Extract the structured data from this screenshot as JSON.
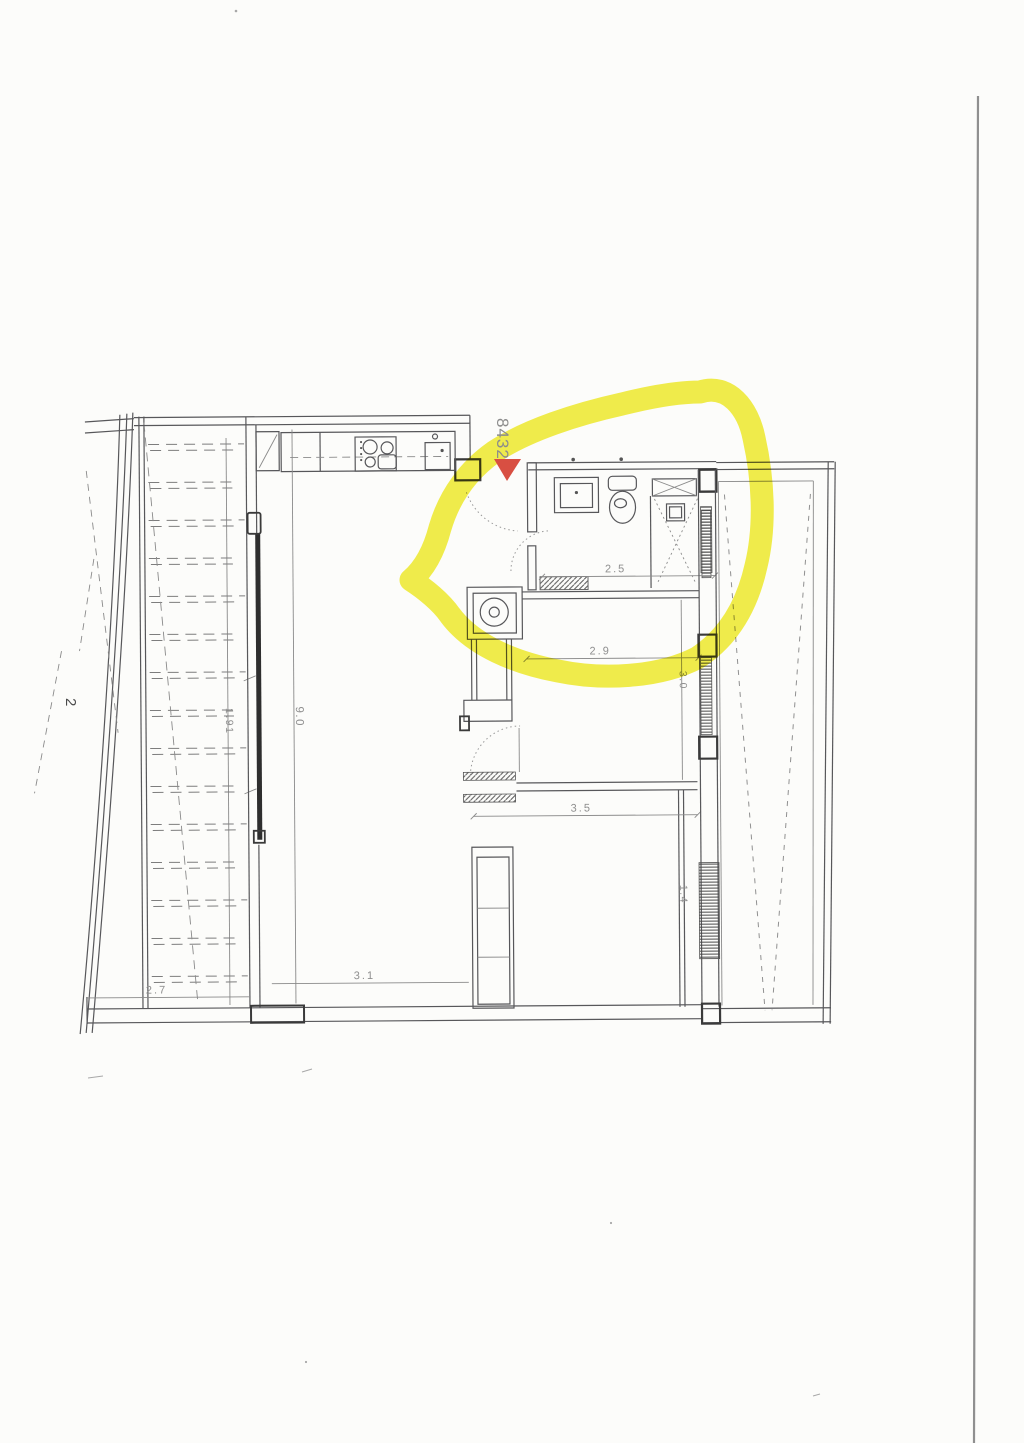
{
  "page": {
    "number": "2",
    "paper_color": "#fcfcfa",
    "scan_edge_color": "#8f8f8f"
  },
  "annotation": {
    "marker_text": "8432",
    "marker_color": "#de584a",
    "arrow_color": "#d84f42",
    "highlight_color": "#f1ed3d"
  },
  "floor_plan": {
    "ink_color": "#57575a",
    "dimensions": {
      "living_length": "9.0",
      "balcony_depth": "1.91",
      "balcony_width": "2.7",
      "living_width": "3.1",
      "bathroom_width": "2.5",
      "middle_room_width": "2.9",
      "middle_room_depth": "3.0",
      "bedroom_width": "3.5",
      "bedroom_window": "1.4"
    }
  }
}
